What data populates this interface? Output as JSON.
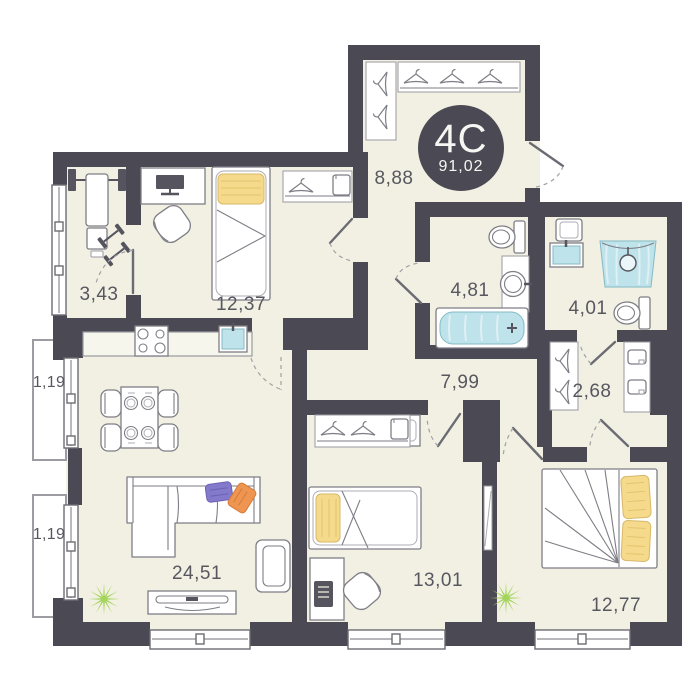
{
  "unit": {
    "type_label": "4C",
    "total_area": "91,02"
  },
  "rooms": {
    "gym": "3,43",
    "bedroom1": "12,37",
    "hall": "8,88",
    "bath": "4,81",
    "shower_room": "4,01",
    "corridor": "7,99",
    "wardrobe": "2,68",
    "balcony1": "1,19",
    "balcony2": "1,19",
    "living": "24,51",
    "bedroom2": "13,01",
    "bedroom3": "12,77"
  },
  "colors": {
    "wall": "#4b4a54",
    "floor": "#f1f0e2",
    "water_blue": "#bfe3ea",
    "pillow_yellow": "#f5da8c",
    "plant_green": "#a4d45c",
    "cushion_purple": "#837acc",
    "cushion_orange": "#ef9552",
    "label_gray": "#585760"
  }
}
